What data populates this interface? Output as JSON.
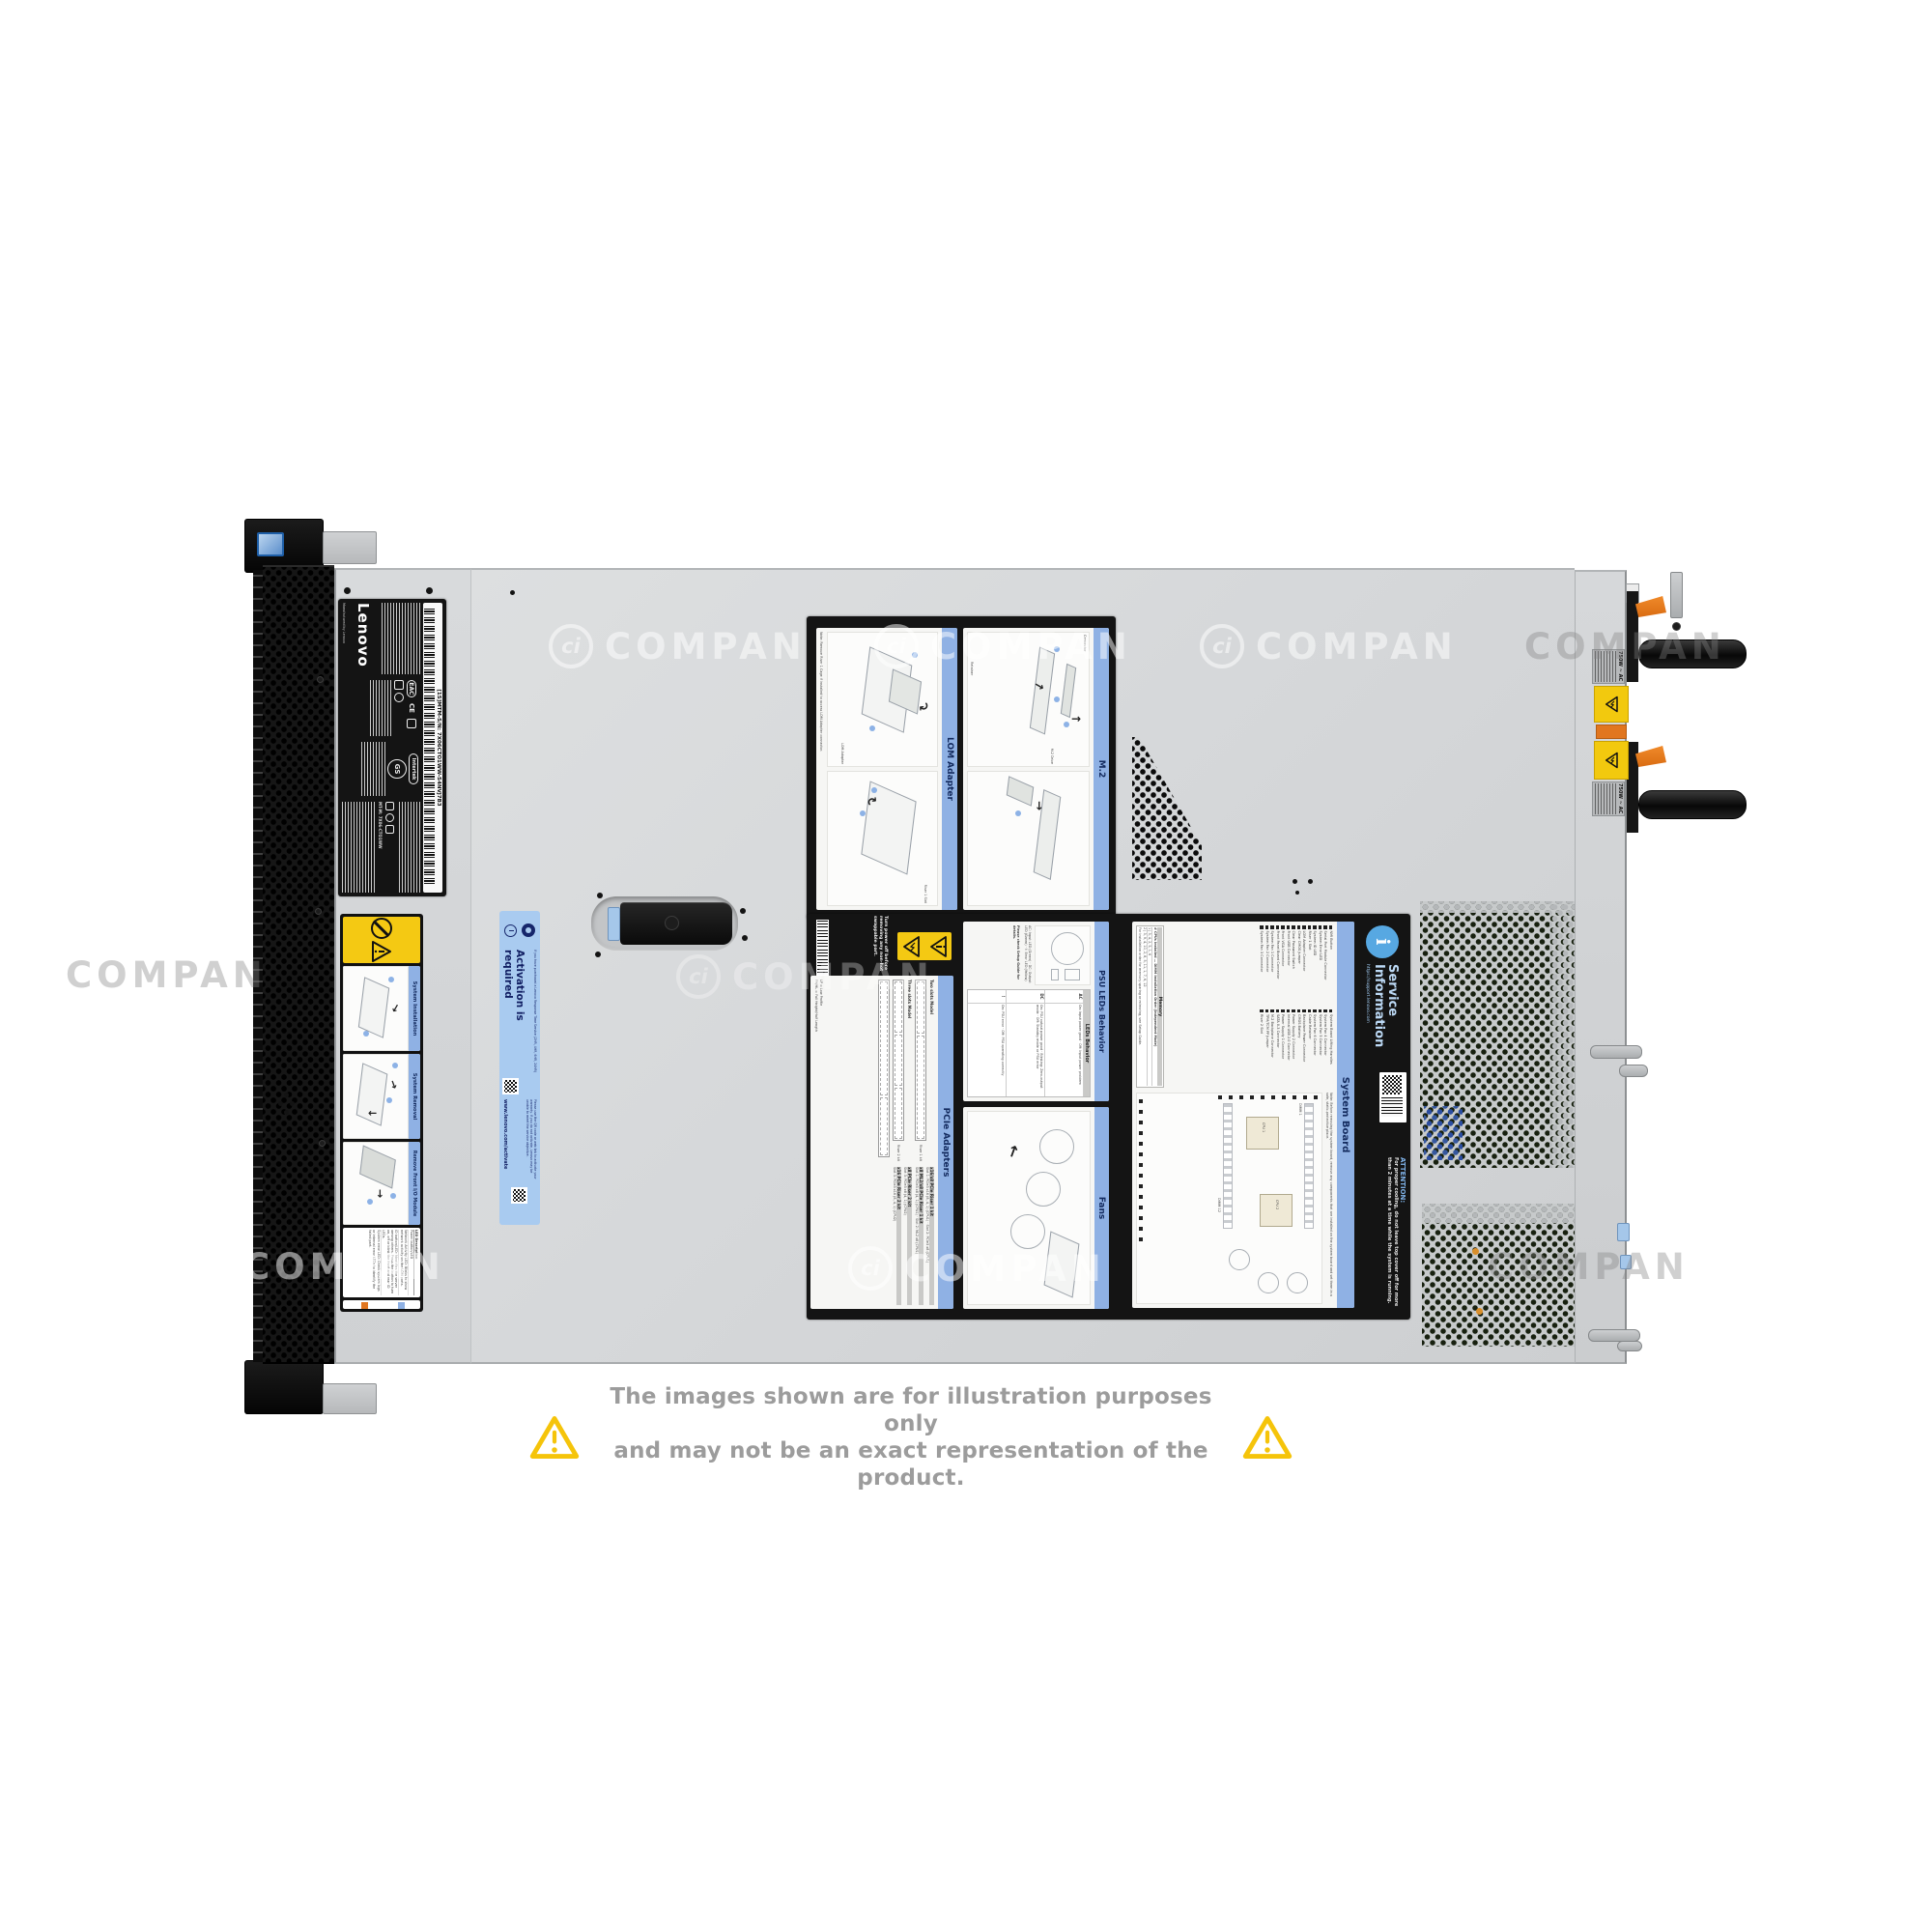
{
  "page": {
    "disclaimer_line1": "The images shown are for illustration purposes only",
    "disclaimer_line2": "and may not be an exact representation of the product.",
    "watermark_text": "COMPAN",
    "watermark_logo": "ci"
  },
  "front": {
    "lenovo_label": {
      "brand": "Lenovo",
      "barcode_text": "[1S]MTM-S/N: 7X06CTO1WW-S4NVJ7B3",
      "mfg_text": "Manufactured by Lenovo",
      "intertek_text": "Intertek",
      "intertek_gs": "GS",
      "cert_eac": "EAC",
      "cert_ce": "CE",
      "model_text": "MT-M: 7X06-CTO1WW"
    },
    "instruction_label": {
      "sections": [
        "System Installation",
        "System Removal",
        "Remove Front I/O Module"
      ],
      "led_header": "LED  Description",
      "led_rows": [
        "Power button/LED",
        "Network Activity LED: Blinks to show network activity on the LOM ports.",
        "ID button/LED: Identifies the server among others. Press the button to turn on, off or blink the front and rear ID LEDs.",
        "System error LED: Check system logs or internal error LEDs to identify the failed part."
      ],
      "legend_touch": "Touch point",
      "legend_hot": "Hot swap point"
    },
    "activation_label": {
      "title": "Activation is required",
      "note1": "If you have purchased a Lenovo Response Time Service (2HR, 4HR, 6HR, 24HR)",
      "note2": "Please use the QR code or web link to activate your warranty. If you do not activate, Lenovo may be unable to meet the service objective.",
      "url": "www.lenovo.com/activate"
    }
  },
  "service_label": {
    "warning_text": "Turn power off before removing any non-hot swappable part.",
    "lom": {
      "title": "LOM Adapter",
      "note": "Note: Remove Riser 1 Cage if installed to access LOM Adapter connector.",
      "callout1": "LOM Adapter",
      "callout2": "Riser 1 Slot"
    },
    "m2": {
      "title": "M.2",
      "callout1": "Connector",
      "callout2": "M.2 Drive",
      "callout3": "Retainer"
    },
    "psu_leds": {
      "title": "PSU LEDs Behavior",
      "table_title": "LEDs Behavior",
      "rows": [
        {
          "led": "AC",
          "behavior": "On: Input power good · Off: Input power problem"
        },
        {
          "led": "DC",
          "behavior": "On: PSU output power good · Blinking: Zero-output mode · Off: Standby mode or PSU error"
        },
        {
          "led": "!",
          "behavior": "On: PSU error · Off: PSU operating correctly"
        }
      ],
      "legend": "AC: Input LED (Green) · DC: Output LED (Green) · !: Error LED (Yellow)",
      "note": "Please check Setup Guide for details."
    },
    "pcie": {
      "title": "PCIe Adapters",
      "model1": "Two slots Model",
      "model2": "Three slots Model",
      "riser1": "Riser 1 kit",
      "riser2": "Riser 2 kit",
      "kits": [
        {
          "name": "x16/x8 PCIe Riser 1 kit",
          "slots": "Slot 1: PCIe3 x16 (8, 4, 1) (CPU1) · Slot 2: PCIe3 x8 (CPU1)"
        },
        {
          "name": "x8 ML2/x8 PCIe Riser 1 kit",
          "slots": "Slot 1: PCIe3 x8 (4, 1) (CPU1) · Slot 2: ML2 x8 (CPU1)"
        },
        {
          "name": "x8 PCIe Riser 2 kit",
          "slots": "Slot 3: PCIe3 x8 (4, 1) (CPU2)"
        },
        {
          "name": "x16 PCIe Riser 2 kit",
          "slots": "Slot 3: PCIe3 x16 (8, 4, 1) (CPU2)"
        }
      ],
      "footnote1": "LP = Low Profile",
      "footnote2": "FH/HL = Full Height/Half Length"
    },
    "fans": {
      "title": "Fans"
    },
    "board": {
      "title": "System Board",
      "items_left": [
        "NMI Button",
        "Serial Port Module Connector",
        "System Error LED",
        "System ID LED",
        "Riser 1 Slot",
        "LOM Adapter Connector",
        "Clear CMOS Jumper",
        "Clear Password Switch",
        "Front USB Connector",
        "Front VGA Connector",
        "Front Panel Board Connector",
        "System Fan 1 Connector",
        "System Fan 2 Connector",
        "System Fan 3 Connector"
      ],
      "items_right": [
        "System Board Lifting Handles",
        "System Fan 4 Connector",
        "System Fan 5 Connector",
        "System Fan 6 Connector",
        "Cable Retainer",
        "Backplane Power Connector",
        "CMOS Battery",
        "Power Supply 2 Connector",
        "Internal USB 2.0 Connector",
        "Power Supply 1 Connector",
        "SATA 0-3 Connector",
        "M.2 Backplane Connector",
        "TPM/TCM PP Jumper",
        "Riser 2 Slot"
      ],
      "note": "Note: Before removing the system board, remove any components that are installed on the system board and set them in a safe, static-protective place.",
      "memory_title": "Memory",
      "memory_header": "# CPUs Installed — DIMM Installation Order (Independent Mode)",
      "memory_rows": [
        "1  |  3, 4, 2, 5, 1, 6",
        "2  |  3, 9, 4, 10, 2, 8, 5, 11, 1, 7, 6, 12"
      ],
      "memory_note": "For installation order for memory sparing or mirroring, see Setup Guide.",
      "cpu1": "CPU 1",
      "cpu2": "CPU 2",
      "dimm1": "DIMM 1",
      "dimm12": "DIMM 12"
    },
    "branding": {
      "title1": "Service",
      "title2": "Information",
      "url": "https://support.lenovo.com",
      "attention_title": "ATTENTION:",
      "attention_text": "For proper cooling, do not leave top cover off for more than 2 minutes at a time while the system is running."
    }
  },
  "rear": {
    "psu1_label": "750W ~ AC",
    "psu2_label": "750W ~ AC"
  }
}
